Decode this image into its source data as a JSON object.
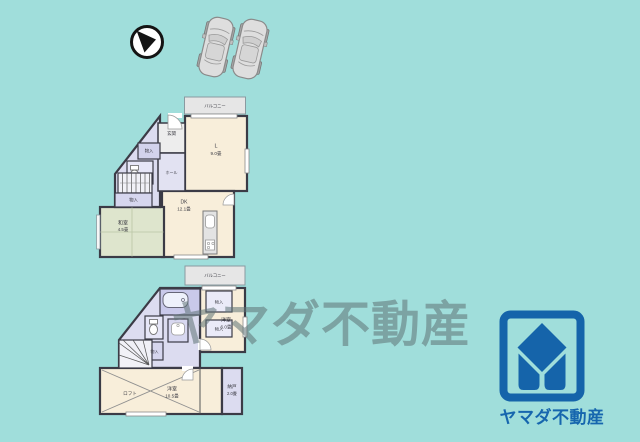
{
  "colors": {
    "background": "#a0dedb",
    "wall": "#3b3b46",
    "room_cream": "#f8eeda",
    "room_lavender": "#dcdcf0",
    "tatami_green": "#dee5cd",
    "logo_blue": "#1564aa",
    "watermark_gray": "#5f7376"
  },
  "watermark": {
    "text": "ヤマダ不動産"
  },
  "logo": {
    "brand": "ヤマダ不動産"
  },
  "floor1": {
    "balcony": "バルコニー",
    "living": "L",
    "living_size": "9.0畳",
    "dk": "DK",
    "dk_size": "12.1畳",
    "washitsu": "和室",
    "washitsu_size": "4.5畳",
    "genkan": "玄関",
    "hall": "ホール",
    "storage_upper": "物入",
    "storage_lower": "物入"
  },
  "floor2": {
    "balcony": "バルコニー",
    "bedroom_right": "洋室",
    "bedroom_right_size": "6.0畳",
    "bedroom_main": "洋室",
    "bedroom_main_size": "10.5畳",
    "loft": "ロフト",
    "nando": "納戸",
    "nando_size": "2.0畳",
    "closet1": "物入",
    "closet2": "物入",
    "closet3": "物入"
  }
}
